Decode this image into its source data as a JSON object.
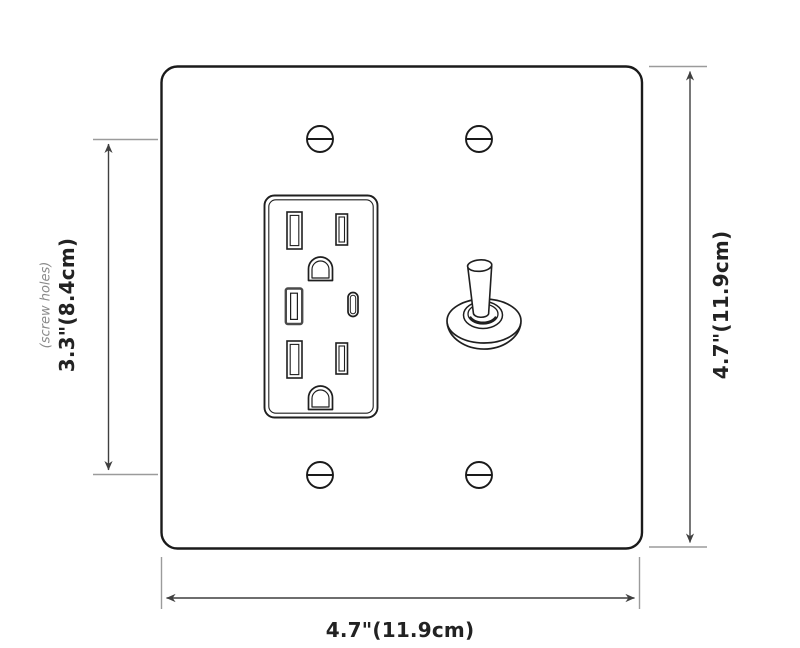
{
  "diagram": {
    "labels": {
      "screw_spacing": "3.3\"(8.4cm)",
      "screw_note": "(screw holes)",
      "plate_height": "4.7\"(11.9cm)",
      "plate_width": "4.7\"(11.9cm)"
    },
    "icons": {
      "screw": "slotted-screw-head",
      "outlet": "duplex-usb-outlet",
      "ground_hole": "d-shaped-ground-hole",
      "usb_a": "usb-a-port",
      "usb_c": "usb-c-port",
      "toggle": "toggle-switch-lever",
      "arrow": "double-headed-dimension-arrow"
    },
    "colors": {
      "background": "#ffffff",
      "outline": "#1a1a1a",
      "dimension_line": "#3f3f3f",
      "extension_tick": "#9b9b9b",
      "label_text": "#222222",
      "muted_label_text": "#8a8a8a"
    }
  }
}
